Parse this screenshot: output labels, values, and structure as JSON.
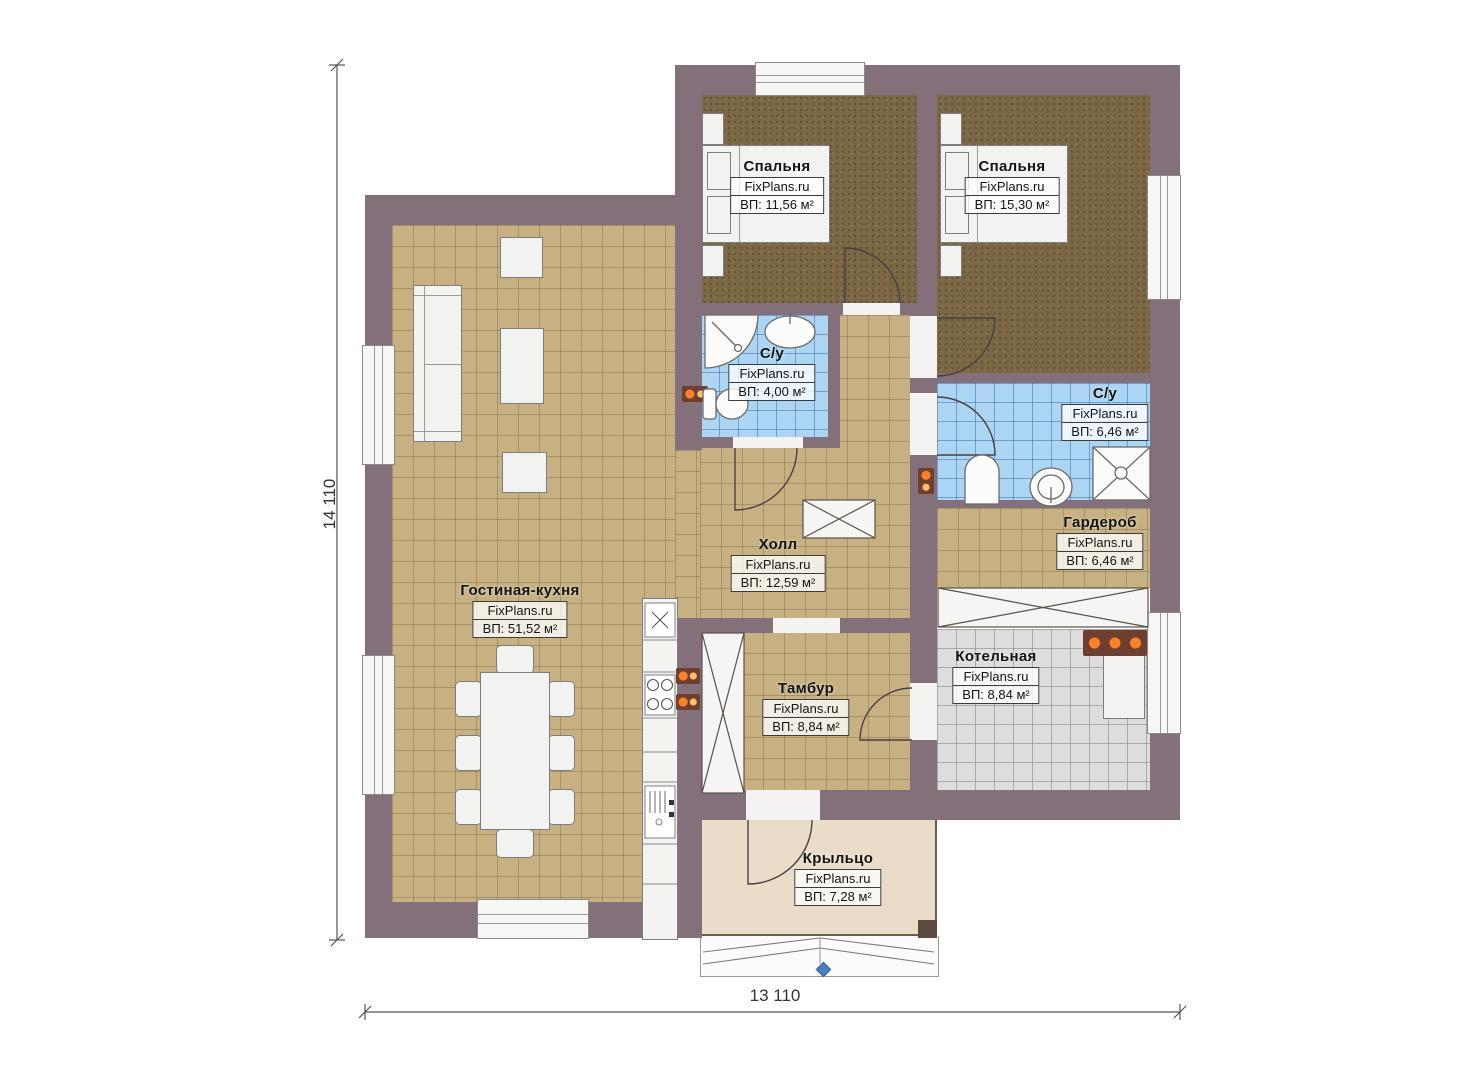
{
  "plan": {
    "watermark": "FixPlans.ru",
    "dimensions": {
      "height_label": "14 110",
      "width_label": "13 110"
    },
    "rooms": [
      {
        "name": "Спальня",
        "area": "ВП: 11,56 м²"
      },
      {
        "name": "Спальня",
        "area": "ВП: 15,30 м²"
      },
      {
        "name": "С/у",
        "area": "ВП: 4,00 м²"
      },
      {
        "name": "С/у",
        "area": "ВП: 6,46 м²"
      },
      {
        "name": "Гардероб",
        "area": "ВП: 6,46 м²"
      },
      {
        "name": "Холл",
        "area": "ВП: 12,59 м²"
      },
      {
        "name": "Гостиная-кухня",
        "area": "ВП: 51,52 м²"
      },
      {
        "name": "Тамбур",
        "area": "ВП: 8,84 м²"
      },
      {
        "name": "Котельная",
        "area": "ВП: 8,84 м²"
      },
      {
        "name": "Крыльцо",
        "area": "ВП: 7,28 м²"
      }
    ],
    "colors": {
      "wall": "#84707a",
      "floor_tile": "#c7b183",
      "carpet": "#7b6743",
      "bath_tile": "#abd5f2",
      "boiler_tile": "#dddddd",
      "porch": "#e9ddc9",
      "outlet_accent": "#ff8126",
      "marker_blue": "#4a7fbf"
    }
  }
}
